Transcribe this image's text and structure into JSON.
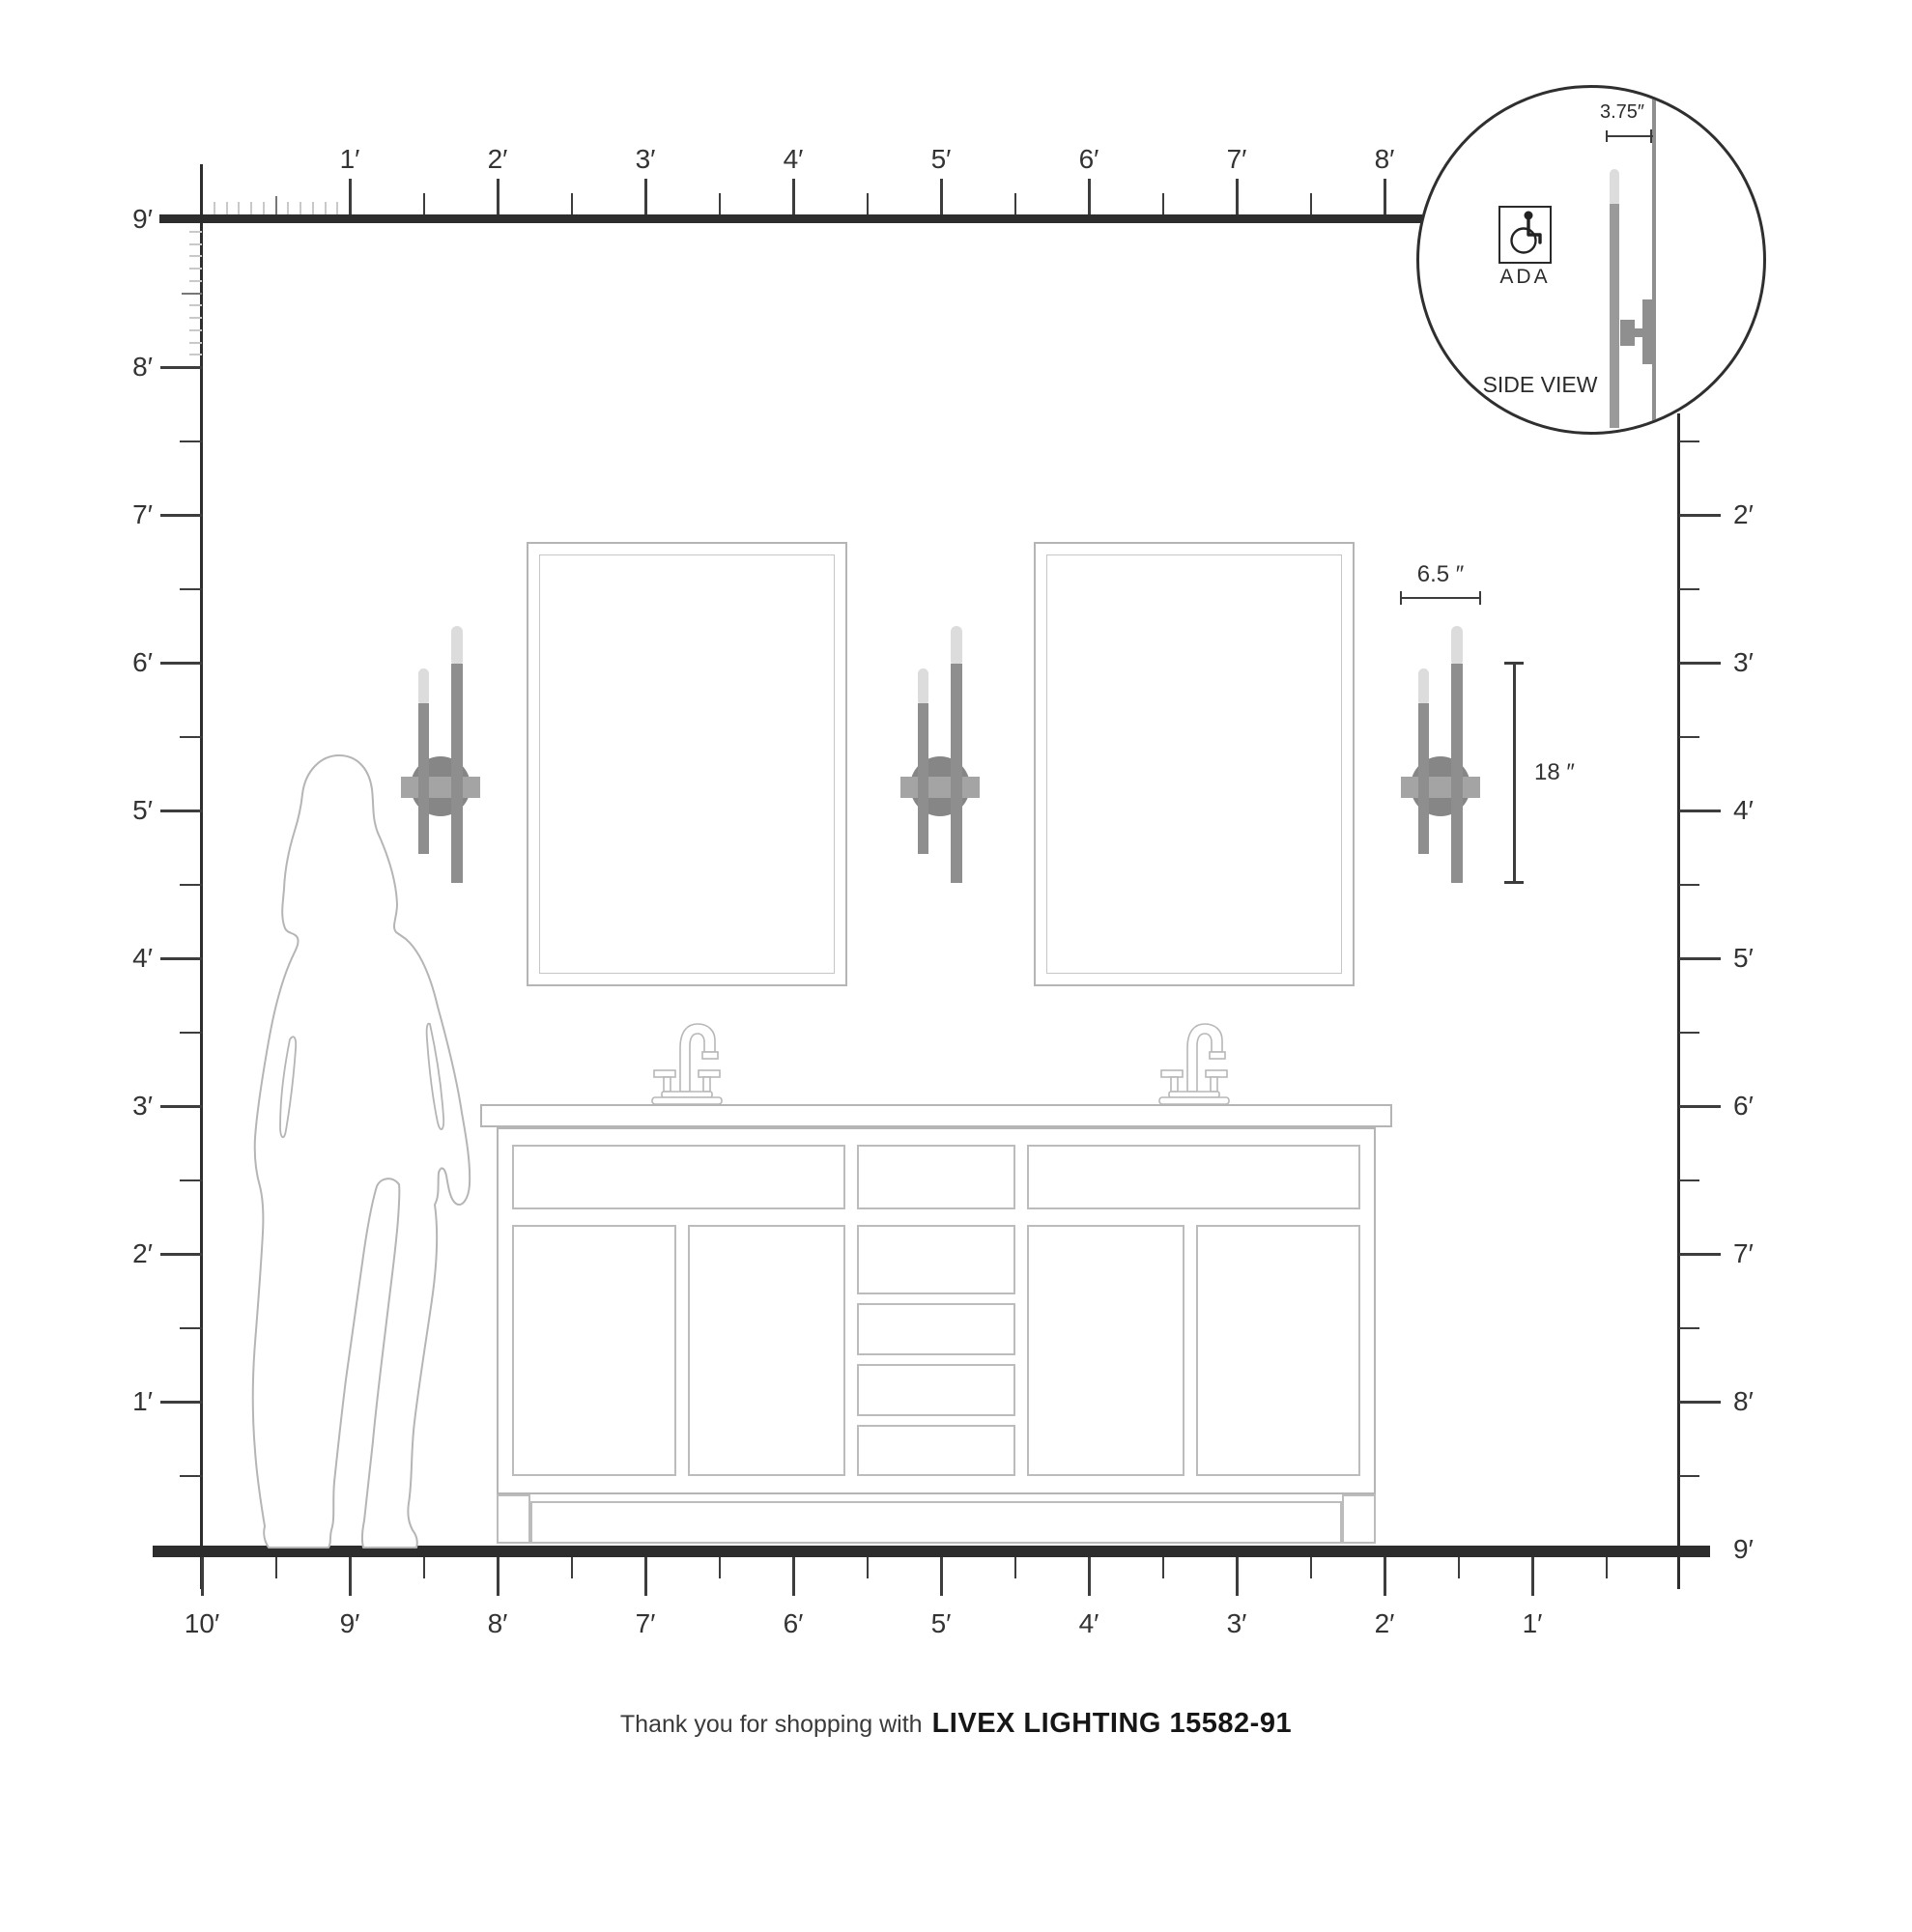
{
  "rulers": {
    "top": {
      "labels": [
        "1′",
        "2′",
        "3′",
        "4′",
        "5′",
        "6′",
        "7′",
        "8′"
      ]
    },
    "bottom": {
      "labels": [
        "10′",
        "9′",
        "8′",
        "7′",
        "6′",
        "5′",
        "4′",
        "3′",
        "2′",
        "1′"
      ]
    },
    "left": {
      "labels": [
        "9′",
        "8′",
        "7′",
        "6′",
        "5′",
        "4′",
        "3′",
        "2′",
        "1′"
      ]
    },
    "right": {
      "labels": [
        "2′",
        "3′",
        "4′",
        "5′",
        "6′",
        "7′",
        "8′",
        "9′"
      ]
    }
  },
  "dimensions": {
    "fixture_width": "6.5 ″",
    "fixture_height": "18 ″"
  },
  "inset": {
    "depth_dim": "3.75″",
    "ada_label": "ADA",
    "side_view_label": "SIDE VIEW"
  },
  "footer": {
    "regular": "Thank you for shopping with",
    "bold": "LIVEX LIGHTING 15582-91"
  },
  "icons": {
    "ada": "wheelchair-icon",
    "person": "woman-silhouette",
    "faucet": "faucet-icon",
    "fixture": "wall-sconce-two-light",
    "inset_fixture": "wall-sconce-side-view"
  },
  "colors": {
    "structure_line": "#2d2d2d",
    "tick": "#3d3d3d",
    "inch_tick": "#c9c9c9",
    "furniture_outline": "#b5b5b5",
    "sconce_rod": "#8e8e8e",
    "sconce_bulb": "#dcdcdc",
    "sconce_plate": "#868686",
    "sconce_arm": "#a4a4a4",
    "label_text": "#333333"
  }
}
